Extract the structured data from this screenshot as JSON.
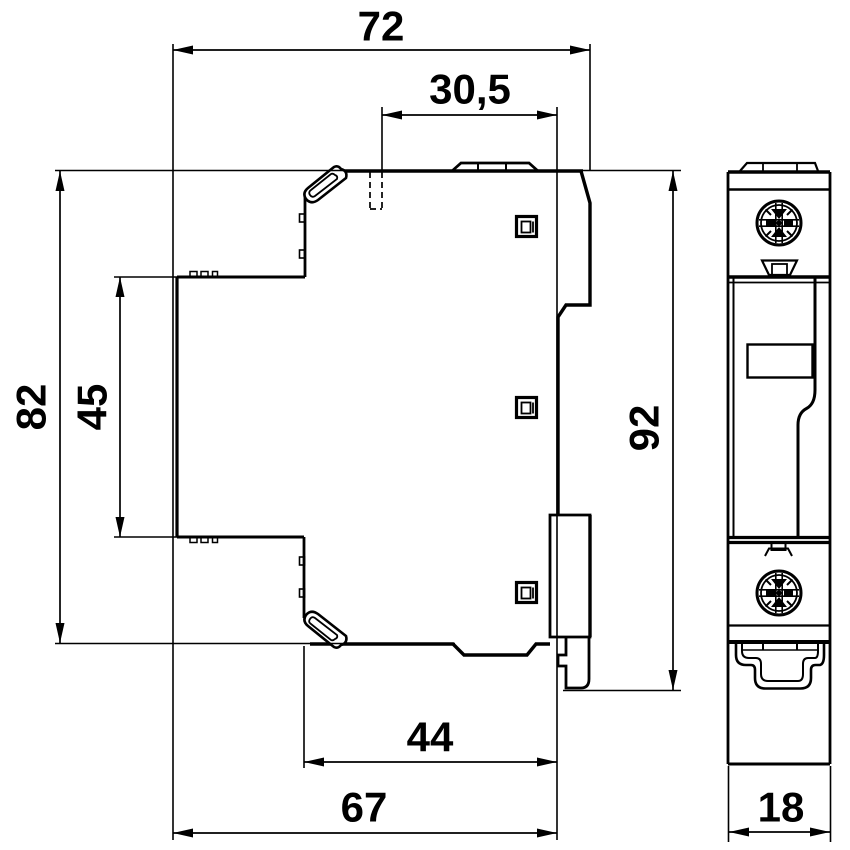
{
  "drawing": {
    "type": "technical-dimension-drawing",
    "colors": {
      "line": "#000000",
      "background": "#ffffff"
    },
    "dimensions": {
      "overall_width": "72",
      "top_offset": "30,5",
      "housing_height": "82",
      "rail_block_height": "45",
      "overall_height": "92",
      "lower_width": "44",
      "base_width": "67",
      "module_width": "18"
    }
  }
}
